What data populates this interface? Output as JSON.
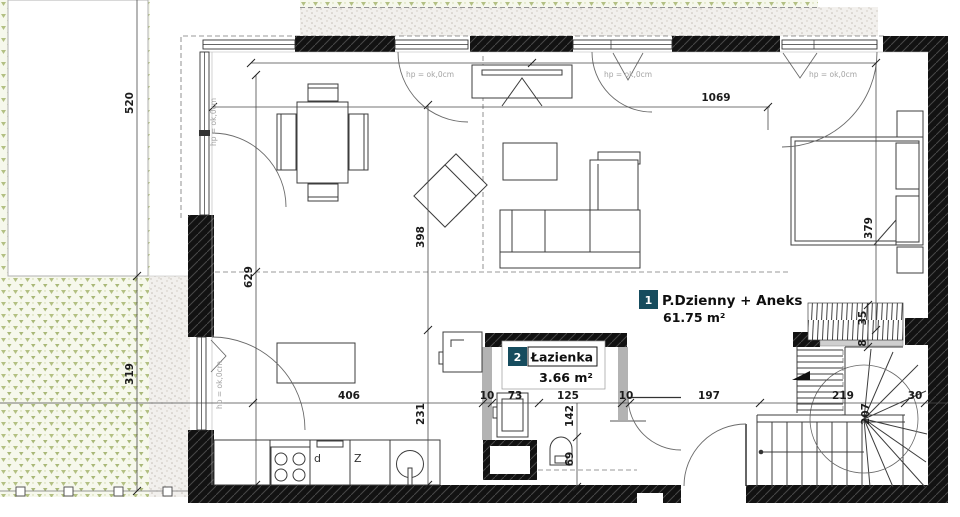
{
  "plan": {
    "rooms": [
      {
        "num": "1",
        "name": "P.Dzienny + Aneks",
        "area": "61.75 m²"
      },
      {
        "num": "2",
        "name": "Łazienka",
        "area": "3.66 m²"
      }
    ],
    "window_head_label": "hp = ok,0cm",
    "kitchen": {
      "dishwasher": "d",
      "sink": "Z"
    },
    "dims": {
      "plot_left_upper": "520",
      "plot_left_lower": "319",
      "interior_width": "1069",
      "interior_depth": "629",
      "living_depth": "398",
      "kitchen_depth": "231",
      "kitchen_width": "406",
      "bed_zone": "379",
      "bath_off1": "10",
      "bath_vanity": "73",
      "bath_width": "125",
      "bath_off2": "10",
      "bath_depth": "142",
      "wc_width": "69",
      "hall_width": "197",
      "stair_width": "219",
      "stair_off": "30",
      "stair_run": "207",
      "rail_width": "35",
      "rail_gap": "8"
    },
    "colors": {
      "badge": "#164c5e"
    }
  }
}
